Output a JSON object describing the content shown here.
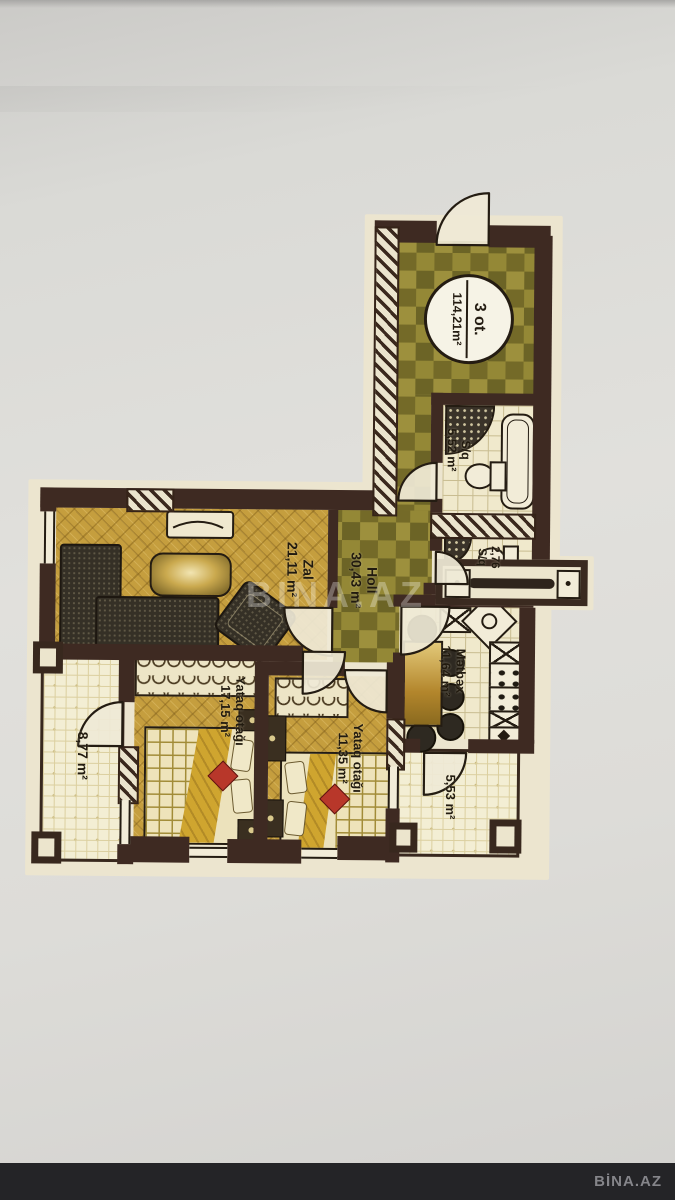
{
  "plan": {
    "badge": {
      "line1": "3 ot.",
      "line2": "114,21m²"
    },
    "rooms": {
      "bathroom": {
        "name": "S/q",
        "area": "5,52 m²"
      },
      "wc": {
        "line1": "2,76",
        "line2": "S/q"
      },
      "holl": {
        "name": "Holl",
        "area": "30,43 m²"
      },
      "zal": {
        "name": "Zal",
        "area": "21,11 m²"
      },
      "bedroom1": {
        "name": "Yataq otağı",
        "area": "17,15 m²"
      },
      "bedroom2": {
        "name": "Yataq otağı",
        "area": "11,35 m²"
      },
      "kitchen": {
        "name": "Mətbəx",
        "area": "11,64 m²"
      },
      "balcony_left": {
        "area": "8,77 m²"
      },
      "balcony_right": {
        "area": "5,53 m²"
      }
    },
    "colors": {
      "wall": "#3e2a22",
      "checker_dark": "#6c6426",
      "checker_light": "#9d903d",
      "gold_floor": "#c59e3e",
      "tile_cream": "#f0e9cc",
      "accent_red": "#b8372a"
    }
  },
  "overlay": {
    "watermark": "BINA.AZ"
  },
  "footer": {
    "brand": "BİNA.AZ"
  }
}
